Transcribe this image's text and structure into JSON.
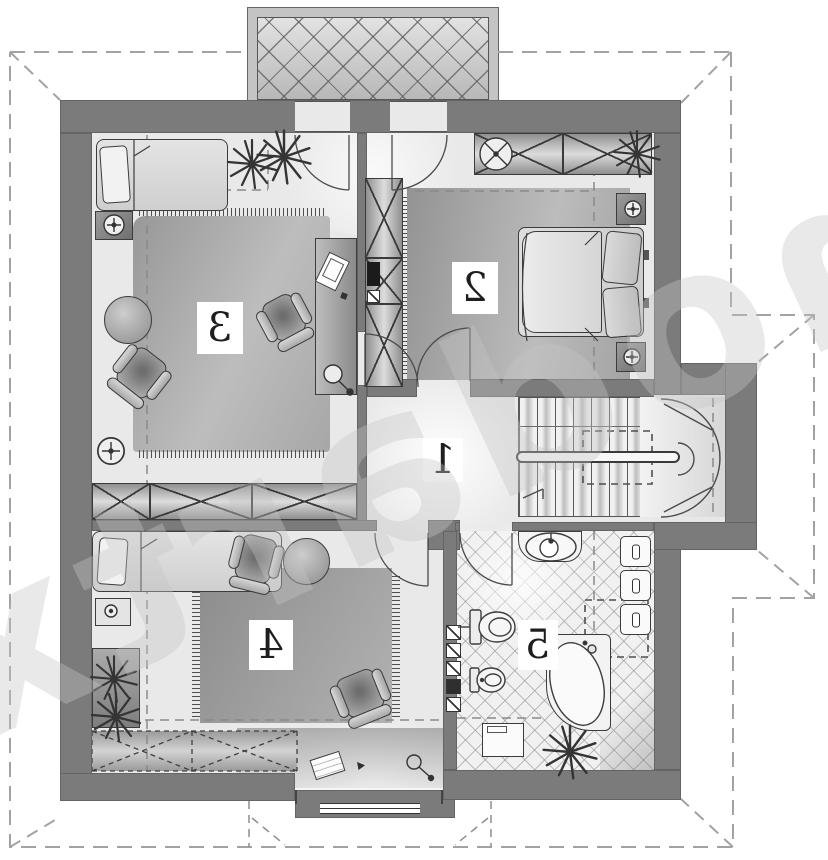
{
  "plan": {
    "watermark": "extradom",
    "rooms": [
      {
        "number": "1"
      },
      {
        "number": "2"
      },
      {
        "number": "3"
      },
      {
        "number": "4"
      },
      {
        "number": "5"
      }
    ],
    "colors": {
      "wall": "#7b7b7b",
      "floor": "#e9e9e9",
      "carpet_dark": "#8f8f8f",
      "carpet_light": "#c2c2c2",
      "outline": "#3c3c3c",
      "dashed_roof": "#a2a2a2",
      "dashed_knee": "#8a8a8a",
      "tile_line": "#c9c9c9",
      "label_bg": "#ffffff"
    }
  }
}
